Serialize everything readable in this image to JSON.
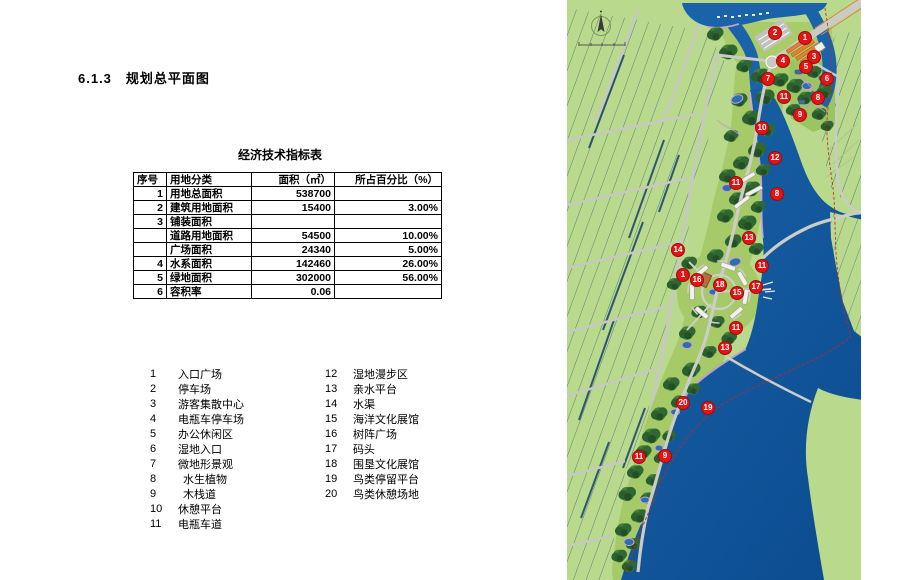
{
  "page": {
    "section_number": "6.1.3",
    "section_title": "规划总平面图"
  },
  "table": {
    "title": "经济技术指标表",
    "headers": [
      "序号",
      "用地分类",
      "面积（㎡）",
      "所占百分比（%）"
    ],
    "rows": [
      [
        "1",
        "用地总面积",
        "538700",
        ""
      ],
      [
        "2",
        "建筑用地面积",
        "15400",
        "3.00%"
      ],
      [
        "3",
        "铺装面积",
        "",
        ""
      ],
      [
        "",
        "道路用地面积",
        "54500",
        "10.00%"
      ],
      [
        "",
        "广场面积",
        "24340",
        "5.00%"
      ],
      [
        "4",
        "水系面积",
        "142460",
        "26.00%"
      ],
      [
        "5",
        "绿地面积",
        "302000",
        "56.00%"
      ],
      [
        "6",
        "容积率",
        "0.06",
        ""
      ]
    ]
  },
  "legend": {
    "left": [
      {
        "num": "1",
        "label": "入口广场",
        "indent": false
      },
      {
        "num": "2",
        "label": "停车场",
        "indent": false
      },
      {
        "num": "3",
        "label": "游客集散中心",
        "indent": false
      },
      {
        "num": "4",
        "label": "电瓶车停车场",
        "indent": false
      },
      {
        "num": "5",
        "label": "办公休闲区",
        "indent": false
      },
      {
        "num": "6",
        "label": "湿地入口",
        "indent": false
      },
      {
        "num": "7",
        "label": "微地形景观",
        "indent": false
      },
      {
        "num": "8",
        "label": "水生植物",
        "indent": true
      },
      {
        "num": "9",
        "label": "木栈道",
        "indent": true
      },
      {
        "num": "10",
        "label": "休憩平台",
        "indent": false
      },
      {
        "num": "11",
        "label": "电瓶车道",
        "indent": false
      }
    ],
    "right": [
      {
        "num": "12",
        "label": "湿地漫步区",
        "indent": false
      },
      {
        "num": "13",
        "label": "亲水平台",
        "indent": false
      },
      {
        "num": "14",
        "label": "水渠",
        "indent": false
      },
      {
        "num": "15",
        "label": "海洋文化展馆",
        "indent": false
      },
      {
        "num": "16",
        "label": "树阵广场",
        "indent": false
      },
      {
        "num": "17",
        "label": "码头",
        "indent": false
      },
      {
        "num": "18",
        "label": "围垦文化展馆",
        "indent": false
      },
      {
        "num": "19",
        "label": "鸟类停留平台",
        "indent": false
      },
      {
        "num": "20",
        "label": "鸟类休憩场地",
        "indent": false
      }
    ]
  },
  "map": {
    "markers": [
      {
        "n": "2",
        "x": 208,
        "y": 33
      },
      {
        "n": "1",
        "x": 238,
        "y": 38
      },
      {
        "n": "3",
        "x": 247,
        "y": 57
      },
      {
        "n": "4",
        "x": 216,
        "y": 61
      },
      {
        "n": "5",
        "x": 239,
        "y": 67
      },
      {
        "n": "7",
        "x": 201,
        "y": 79
      },
      {
        "n": "6",
        "x": 260,
        "y": 79
      },
      {
        "n": "11",
        "x": 217,
        "y": 97
      },
      {
        "n": "8",
        "x": 251,
        "y": 98
      },
      {
        "n": "9",
        "x": 233,
        "y": 115
      },
      {
        "n": "10",
        "x": 195,
        "y": 128
      },
      {
        "n": "12",
        "x": 208,
        "y": 158
      },
      {
        "n": "11",
        "x": 169,
        "y": 183
      },
      {
        "n": "8",
        "x": 210,
        "y": 194
      },
      {
        "n": "13",
        "x": 182,
        "y": 238
      },
      {
        "n": "14",
        "x": 111,
        "y": 250
      },
      {
        "n": "11",
        "x": 195,
        "y": 266
      },
      {
        "n": "1",
        "x": 116,
        "y": 275
      },
      {
        "n": "16",
        "x": 130,
        "y": 280
      },
      {
        "n": "18",
        "x": 153,
        "y": 285
      },
      {
        "n": "17",
        "x": 189,
        "y": 287
      },
      {
        "n": "15",
        "x": 170,
        "y": 293
      },
      {
        "n": "11",
        "x": 169,
        "y": 328
      },
      {
        "n": "13",
        "x": 158,
        "y": 348
      },
      {
        "n": "20",
        "x": 116,
        "y": 403
      },
      {
        "n": "19",
        "x": 141,
        "y": 408
      },
      {
        "n": "11",
        "x": 72,
        "y": 457
      },
      {
        "n": "9",
        "x": 98,
        "y": 456
      }
    ],
    "colors": {
      "farmland": "#b9d98c",
      "water": "#1a63a8",
      "deep_water": "#0d4e92",
      "road": "#c9c9c4",
      "tree_dark": "#2a5f2f",
      "park_band": "#a6ca67",
      "pink_fringe": "#d2a4d6",
      "orange_building": "#e0822f",
      "marker_red": "#e41414",
      "boundary_red": "#cc2222"
    }
  }
}
